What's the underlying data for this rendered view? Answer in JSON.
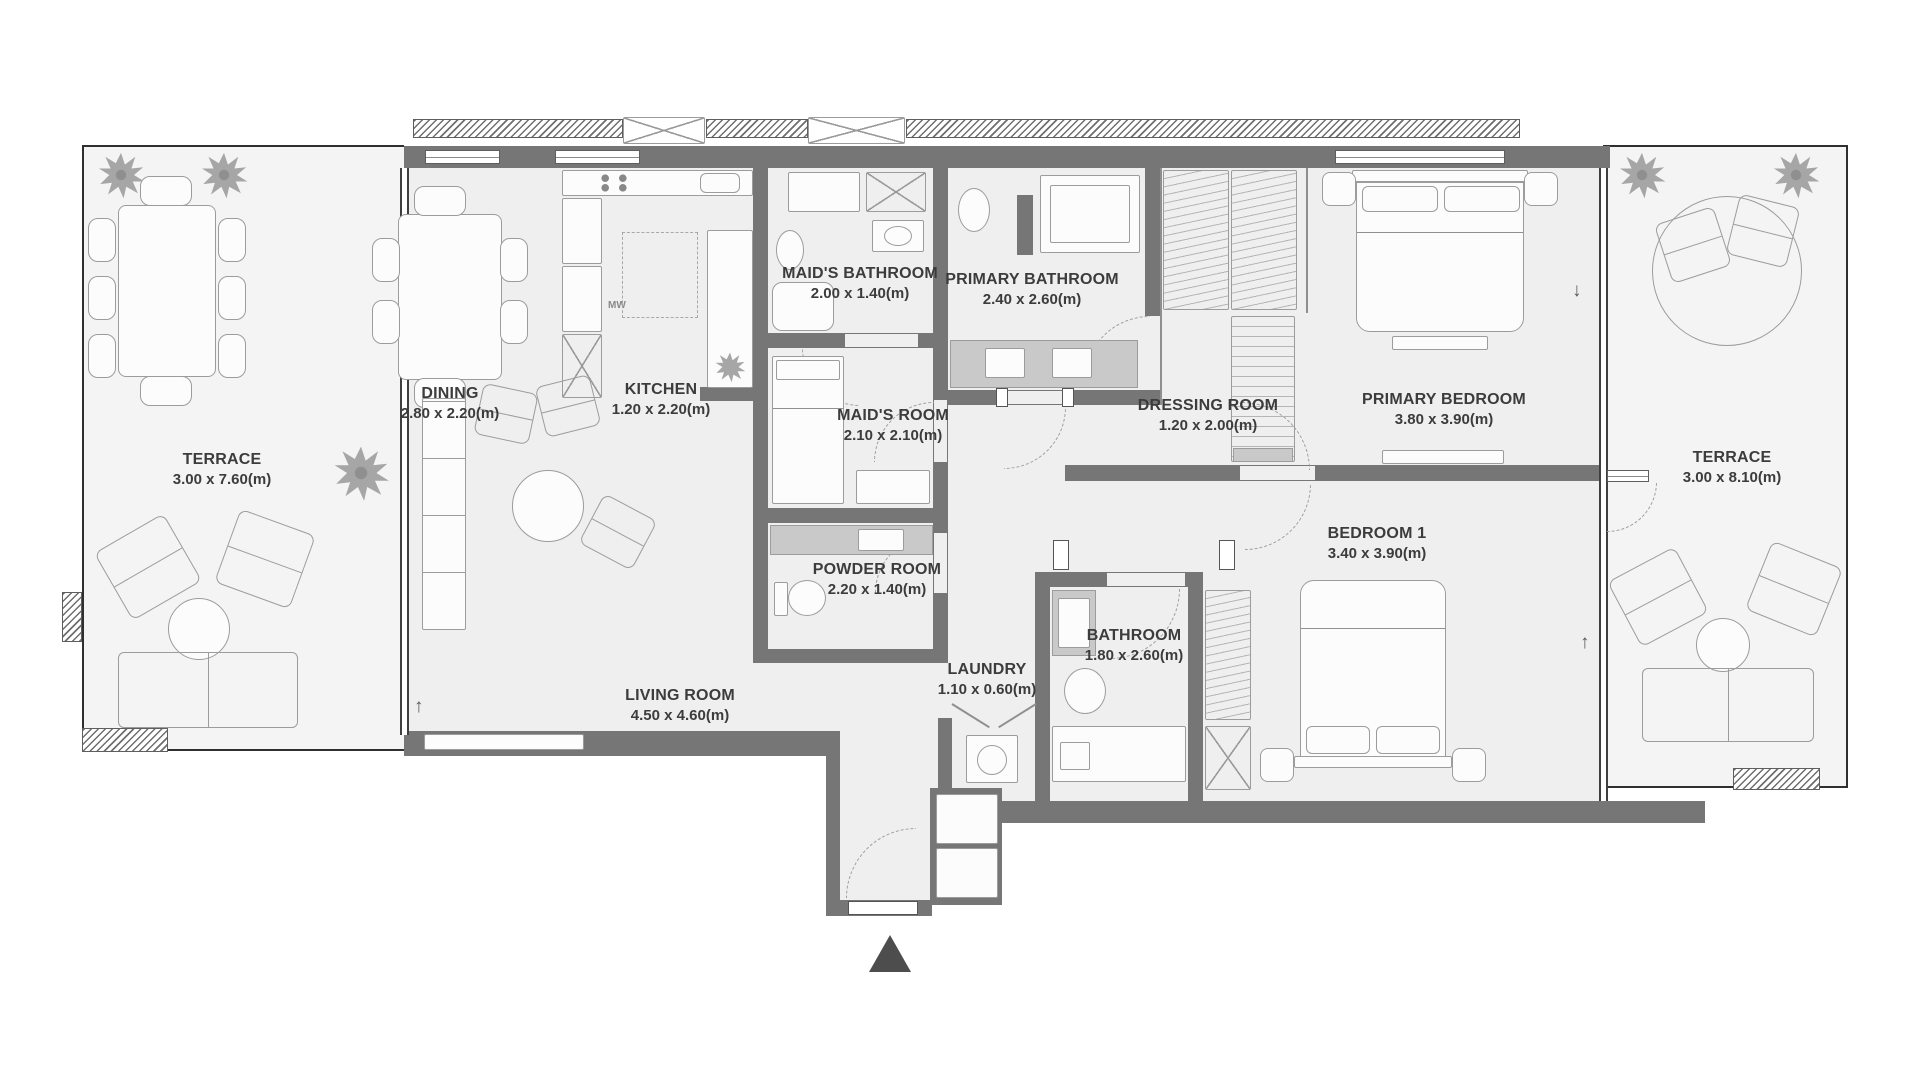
{
  "plan_type": "apartment-floor-plan",
  "rooms": [
    {
      "name": "TERRACE",
      "dims": "3.00 x 7.60(m)"
    },
    {
      "name": "DINING",
      "dims": "2.80 x 2.20(m)"
    },
    {
      "name": "KITCHEN",
      "dims": "1.20 x 2.20(m)"
    },
    {
      "name": "MAID'S BATHROOM",
      "dims": "2.00 x 1.40(m)"
    },
    {
      "name": "PRIMARY BATHROOM",
      "dims": "2.40 x 2.60(m)"
    },
    {
      "name": "MAID'S ROOM",
      "dims": "2.10 x 2.10(m)"
    },
    {
      "name": "DRESSING ROOM",
      "dims": "1.20 x 2.00(m)"
    },
    {
      "name": "PRIMARY BEDROOM",
      "dims": "3.80 x 3.90(m)"
    },
    {
      "name": "TERRACE",
      "dims": "3.00 x 8.10(m)"
    },
    {
      "name": "POWDER ROOM",
      "dims": "2.20 x 1.40(m)"
    },
    {
      "name": "BEDROOM 1",
      "dims": "3.40 x 3.90(m)"
    },
    {
      "name": "LIVING ROOM",
      "dims": "4.50 x 4.60(m)"
    },
    {
      "name": "LAUNDRY",
      "dims": "1.10 x 0.60(m)"
    },
    {
      "name": "BATHROOM",
      "dims": "1.80 x 2.60(m)"
    }
  ],
  "kitchen": {
    "mw_label": "MW"
  },
  "symbols": {
    "up_arrow": "↑",
    "down_arrow": "↓"
  },
  "colors": {
    "wall": "#767676",
    "floor": "#efefef",
    "boundary": "#2f2f2f",
    "entrance_marker": "#4d4d4d"
  }
}
